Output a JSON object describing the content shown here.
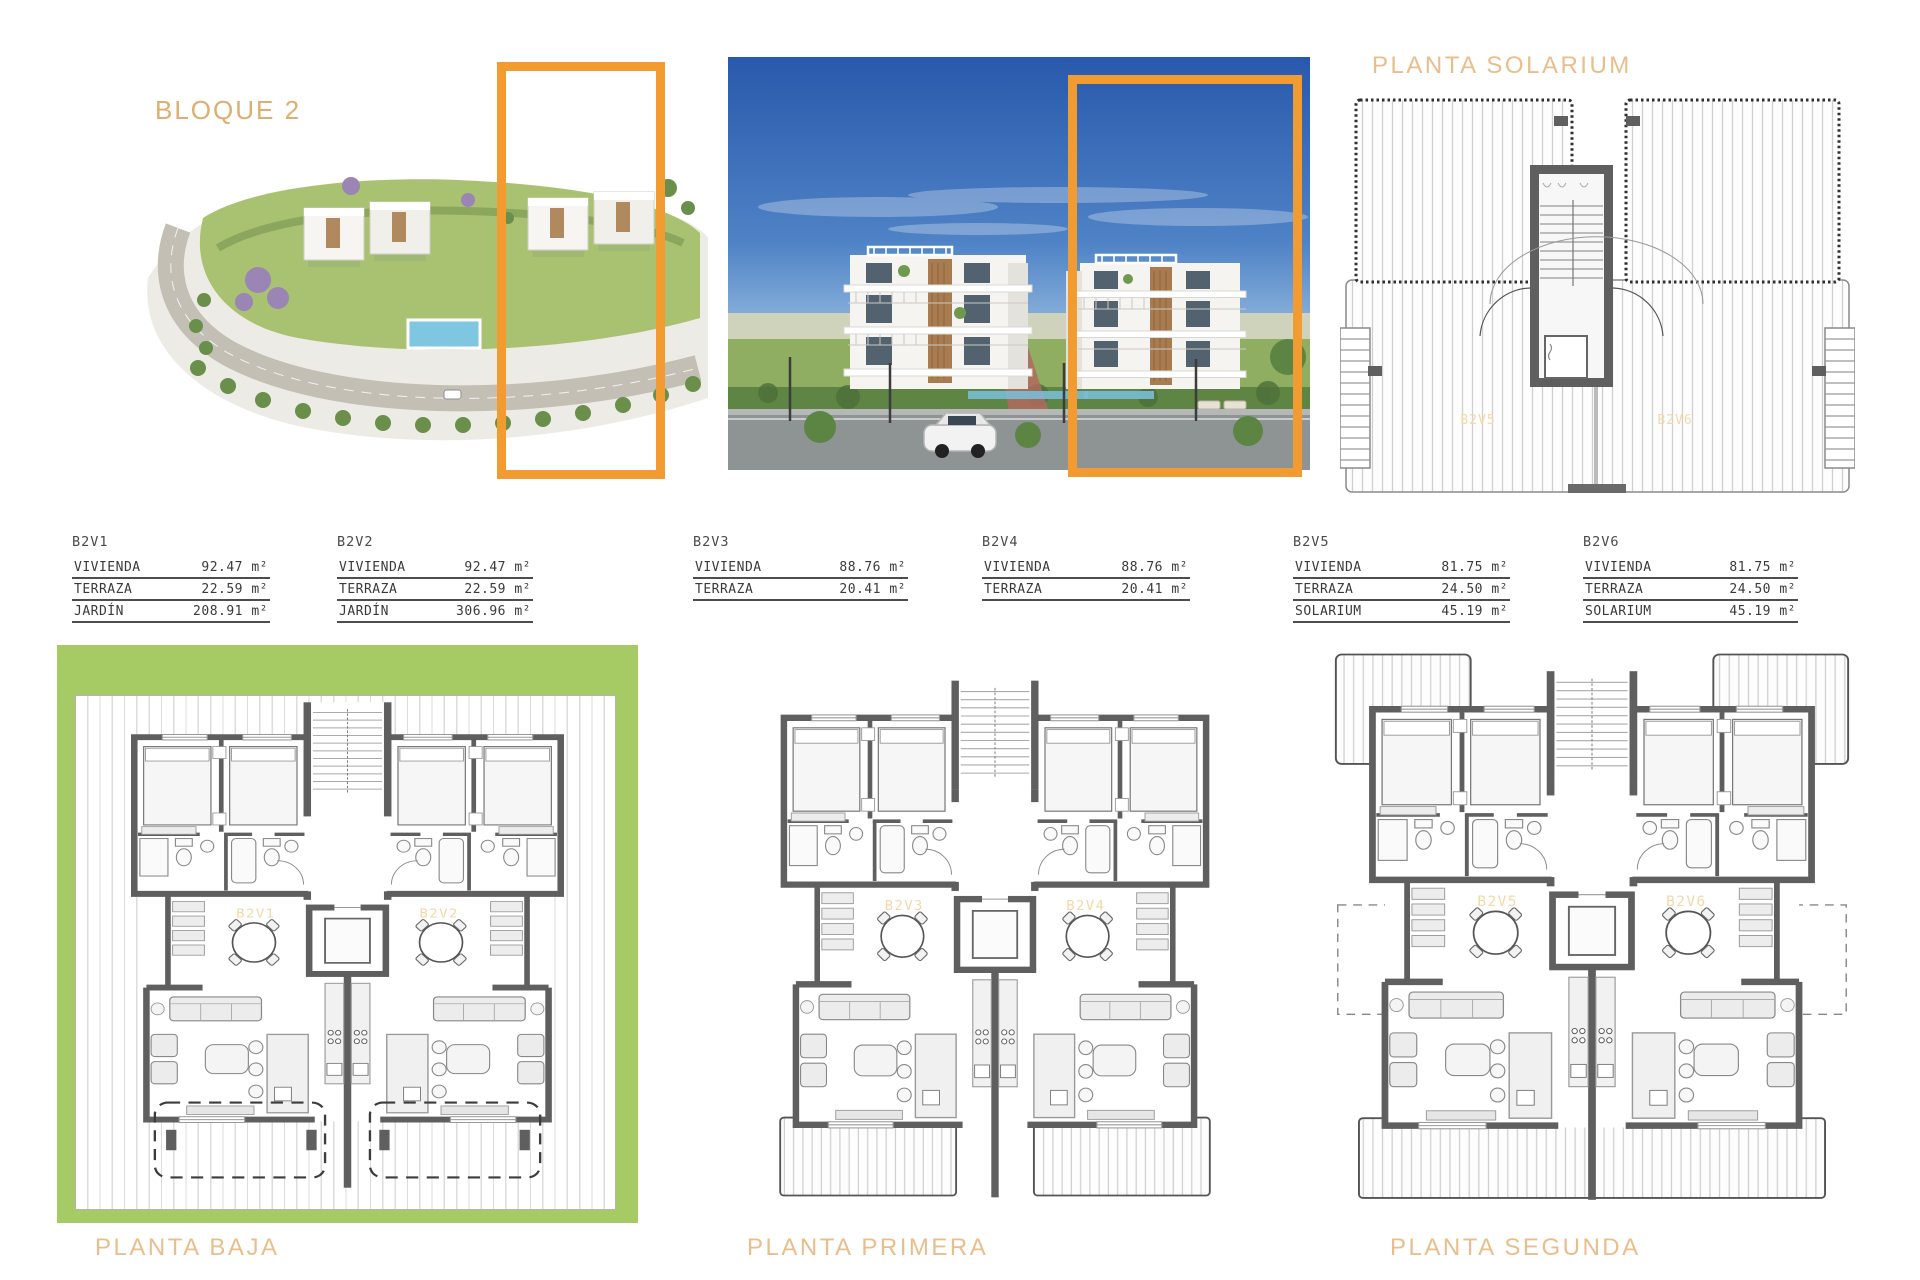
{
  "header": {
    "block_title": "BLOQUE 2"
  },
  "colors": {
    "accent_orange": "#F29B31",
    "title_tan": "#E8BE8C",
    "label_tan": "#F3D8A9",
    "garden_green": "#A6CB64",
    "wall_gray": "#5F5F5F"
  },
  "tables": [
    {
      "id": "B2V1",
      "rows": [
        {
          "label": "VIVIENDA",
          "value": "92.47 m²"
        },
        {
          "label": "TERRAZA",
          "value": "22.59 m²"
        },
        {
          "label": "JARDÍN",
          "value": "208.91 m²"
        }
      ]
    },
    {
      "id": "B2V2",
      "rows": [
        {
          "label": "VIVIENDA",
          "value": "92.47 m²"
        },
        {
          "label": "TERRAZA",
          "value": "22.59 m²"
        },
        {
          "label": "JARDÍN",
          "value": "306.96 m²"
        }
      ]
    },
    {
      "id": "B2V3",
      "rows": [
        {
          "label": "VIVIENDA",
          "value": "88.76 m²"
        },
        {
          "label": "TERRAZA",
          "value": "20.41 m²"
        }
      ]
    },
    {
      "id": "B2V4",
      "rows": [
        {
          "label": "VIVIENDA",
          "value": "88.76 m²"
        },
        {
          "label": "TERRAZA",
          "value": "20.41 m²"
        }
      ]
    },
    {
      "id": "B2V5",
      "rows": [
        {
          "label": "VIVIENDA",
          "value": "81.75 m²"
        },
        {
          "label": "TERRAZA",
          "value": "24.50 m²"
        },
        {
          "label": "SOLARIUM",
          "value": "45.19 m²"
        }
      ]
    },
    {
      "id": "B2V6",
      "rows": [
        {
          "label": "VIVIENDA",
          "value": "81.75 m²"
        },
        {
          "label": "TERRAZA",
          "value": "24.50 m²"
        },
        {
          "label": "SOLARIUM",
          "value": "45.19 m²"
        }
      ]
    }
  ],
  "plans": {
    "solarium": {
      "title": "PLANTA SOLARIUM",
      "left_unit": "B2V5",
      "right_unit": "B2V6"
    },
    "baja": {
      "title": "PLANTA BAJA",
      "left_unit": "B2V1",
      "right_unit": "B2V2"
    },
    "primera": {
      "title": "PLANTA PRIMERA",
      "left_unit": "B2V3",
      "right_unit": "B2V4"
    },
    "segunda": {
      "title": "PLANTA SEGUNDA",
      "left_unit": "B2V5",
      "right_unit": "B2V6"
    }
  }
}
